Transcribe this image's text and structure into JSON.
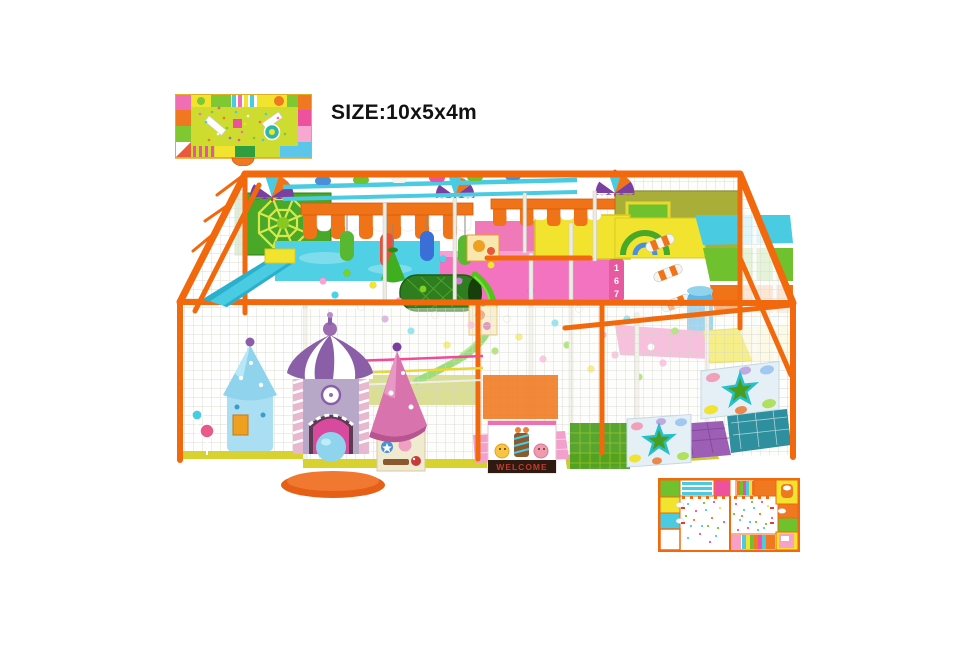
{
  "page": {
    "width": 972,
    "height": 648,
    "background": "#ffffff"
  },
  "header": {
    "size_label": "SIZE:10x5x4m"
  },
  "main_render": {
    "welcome_sign_text": "WELCOME",
    "climb_numbers": [
      "1",
      "6",
      "7"
    ]
  },
  "palette": {
    "frame_orange": "#f2690d",
    "awning_orange": "#f07318",
    "net_white": "#f6f6f2",
    "cyan": "#49cbe2",
    "green": "#6fc22e",
    "dark_green": "#3f9c23",
    "yellow": "#f2e32e",
    "pink": "#f473c0",
    "magenta": "#ee519e",
    "castle_purple": "#8a5fa8",
    "sky_blue": "#8fd4ec",
    "mat_orange": "#e55f17",
    "olive": "#b0b83a",
    "welcome_banner": "#2e1a10",
    "welcome_text": "#c23b2e"
  }
}
